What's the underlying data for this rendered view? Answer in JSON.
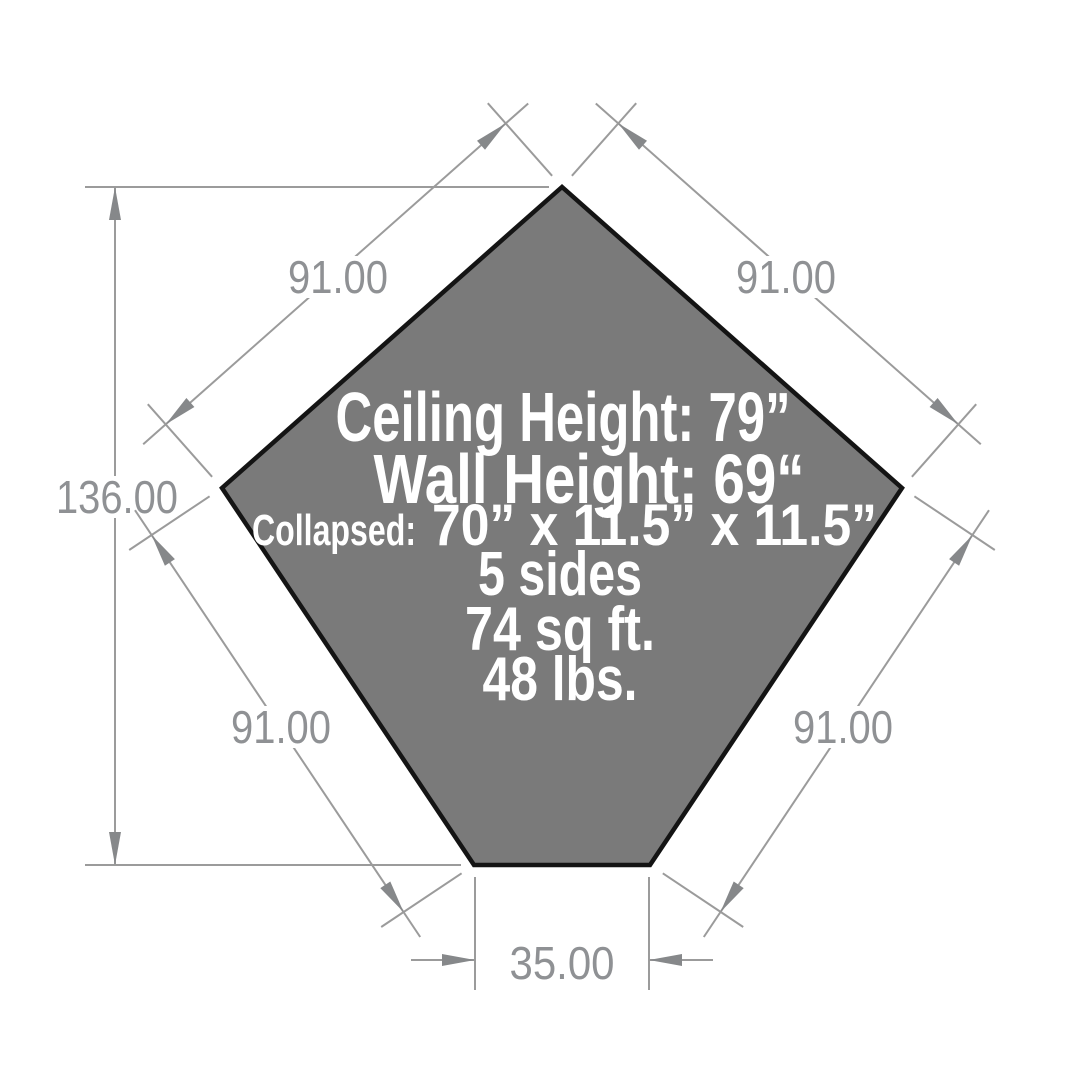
{
  "diagram": {
    "title": "Pentagon shelter dimension drawing",
    "shape": "pentagon",
    "colors": {
      "shape_fill": "#7a7a7a",
      "shape_outline": "#141414",
      "dimension_gray": "#9b9b9b",
      "spec_text": "#ffffff",
      "background": "#ffffff"
    }
  },
  "dimensions": {
    "top_left_edge": "91.00",
    "top_right_edge": "91.00",
    "bottom_left_edge": "91.00",
    "bottom_right_edge": "91.00",
    "overall_height": "136.00",
    "bottom_edge": "35.00"
  },
  "specs": {
    "ceiling_height": "Ceiling Height: 79”",
    "wall_height": "Wall Height: 69“",
    "collapsed_label": "Collapsed:",
    "collapsed_value": "70” x 11.5” x 11.5”",
    "sides": "5 sides",
    "area": "74 sq ft.",
    "weight": "48 lbs."
  }
}
